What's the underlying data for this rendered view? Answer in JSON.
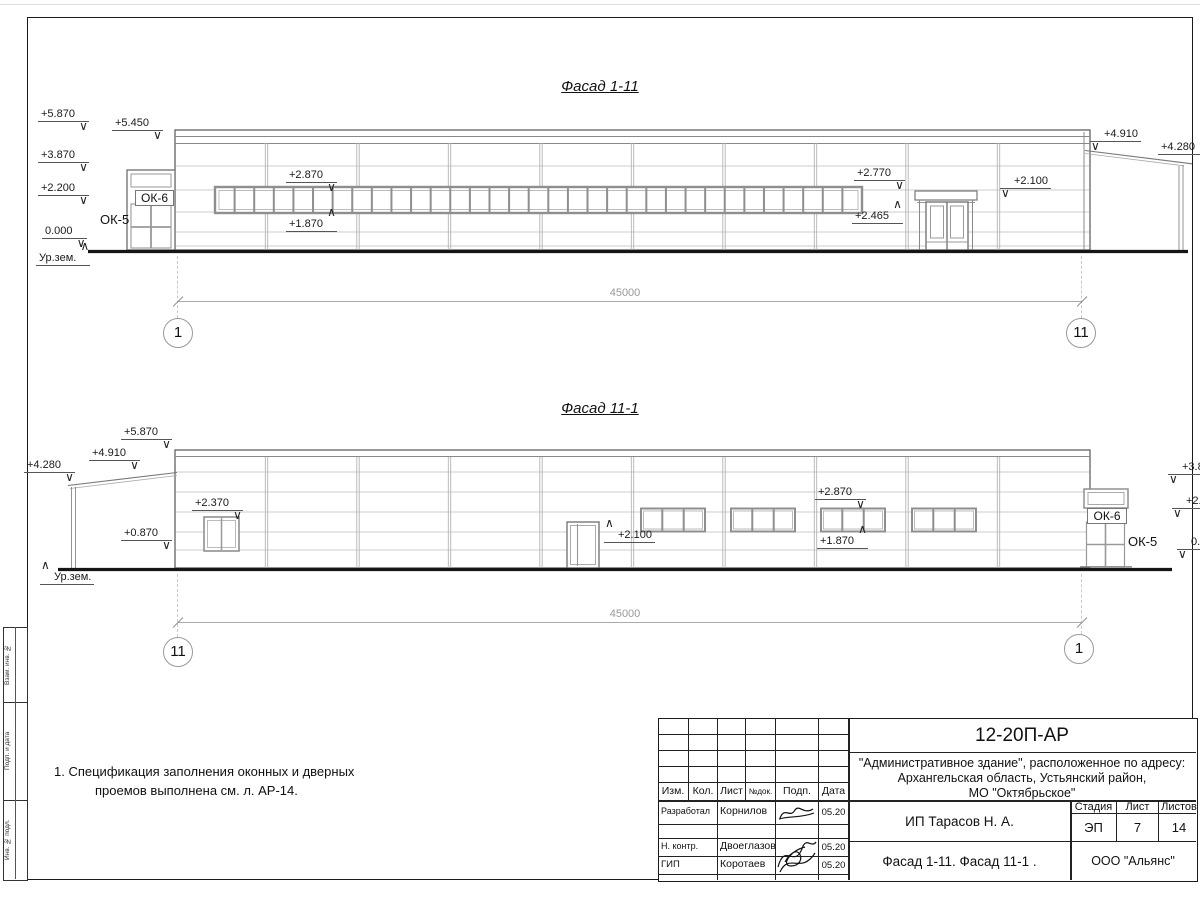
{
  "facade1": {
    "title": "Фасад 1-11",
    "dim": "45000",
    "axis_left": "1",
    "axis_right": "11",
    "ribbon_pane_count": 33,
    "marks": {
      "m5870": "+5.870",
      "m5450": "+5.450",
      "m3870": "+3.870",
      "m2200": "+2.200",
      "m0000": "0.000",
      "ground": "Ур.зем.",
      "ok5": "ОК-5",
      "ok6": "ОК-6",
      "m2870": "+2.870",
      "m1870": "+1.870",
      "m2770": "+2.770",
      "m2465": "+2.465",
      "m2100": "+2.100",
      "m4910": "+4.910",
      "m4280": "+4.280"
    }
  },
  "facade2": {
    "title": "Фасад 11-1",
    "dim": "45000",
    "axis_left": "11",
    "axis_right": "1",
    "three_pane_windows": 4,
    "marks": {
      "m5870": "+5.870",
      "m4910": "+4.910",
      "m4280": "+4.280",
      "m2370": "+2.370",
      "m0870": "+0.870",
      "ground": "Ур.зем.",
      "m2100": "+2.100",
      "m2870": "+2.870",
      "m1870": "+1.870",
      "ok6": "ОК-6",
      "ok5": "ОК-5",
      "m3870r": "+3.870",
      "m2200r": "+2.200",
      "m0000r": "0.000"
    }
  },
  "note": {
    "line1": "1. Спецификация заполнения оконных и дверных",
    "line2": "проемов выполнена см. л. АР-14."
  },
  "titleblock": {
    "doc_number": "12-20П-АР",
    "project_line1": "\"Административное здание\", расположенное по адресу:",
    "project_line2": "Архангельская область, Устьянский район,",
    "project_line3": "МО \"Октябрьское\"",
    "header_cols": [
      "Изм.",
      "Кол.",
      "Лист",
      "№док.",
      "Подп.",
      "Дата"
    ],
    "rows": [
      {
        "role": "Разработал",
        "name": "Корнилов",
        "date": "05.20"
      },
      {
        "role": "Н. контр.",
        "name": "Двоеглазов",
        "date": "05.20"
      },
      {
        "role": "ГИП",
        "name": "Коротаев",
        "date": "05.20"
      }
    ],
    "client": "ИП Тарасов Н. А.",
    "sheet_title": "Фасад 1-11. Фасад 11-1 .",
    "stage_label": "Стадия",
    "sheet_label": "Лист",
    "sheets_label": "Листов",
    "stage": "ЭП",
    "sheet": "7",
    "sheets": "14",
    "company": "ООО \"Альянс\""
  },
  "side_column": {
    "labels": [
      "Взам. инв. №",
      "Подп. и дата",
      "Инв. № подл."
    ]
  }
}
